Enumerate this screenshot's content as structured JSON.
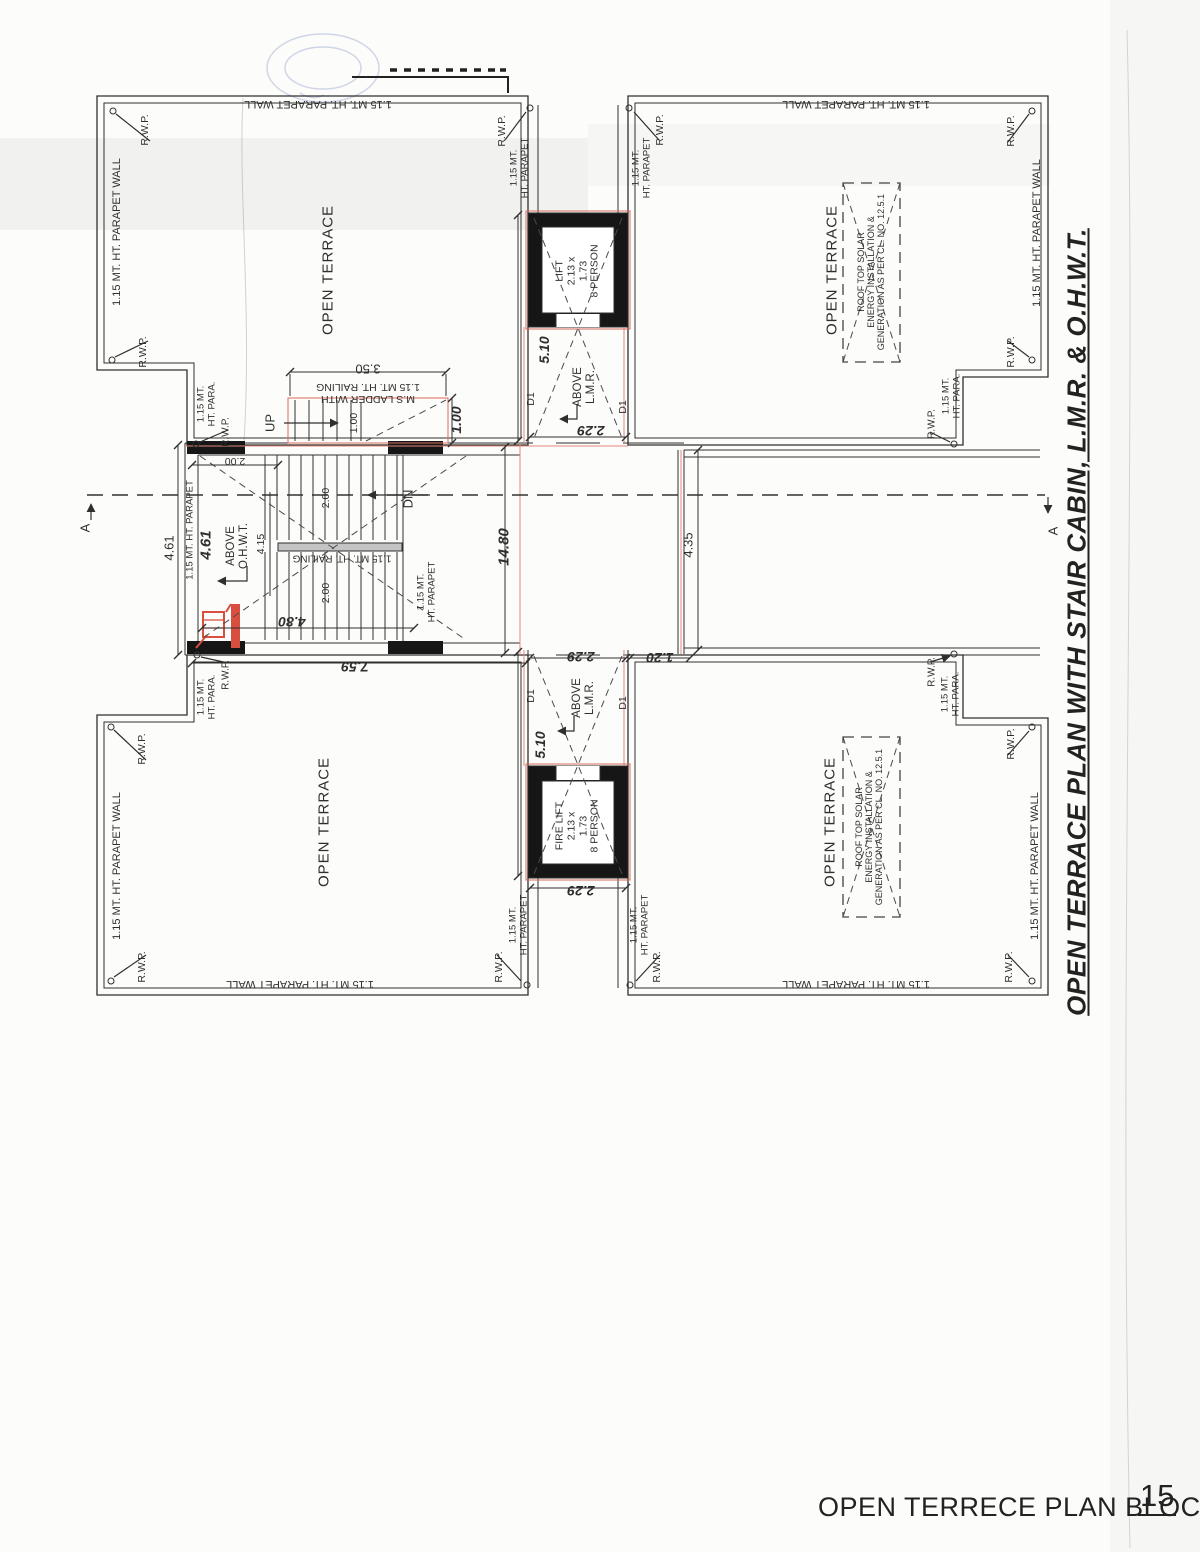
{
  "drawing": {
    "title": "OPEN TERRACE PLAN  WITH STAIR CABIN, L.M.R. & O.H.W.T.",
    "caption": "OPEN TERRECE PLAN BLOCK C",
    "page_number": "15"
  },
  "colors": {
    "line": "#2f2f2f",
    "wall_fill": "#161616",
    "red_overlay": "#d96a5c",
    "stamp_blue": "#7286bd",
    "paper": "#fcfcfa"
  },
  "labels": [
    {
      "n": "parapet-wall-label",
      "t": "1.15 MT. HT. PARAPET WALL",
      "x": 318,
      "y": 104,
      "r": 180,
      "s": 11
    },
    {
      "n": "parapet-wall-label",
      "t": "1.15 MT. HT. PARAPET WALL",
      "x": 117,
      "y": 232,
      "r": -90,
      "s": 11
    },
    {
      "n": "rwp-label",
      "t": "R.W.P.",
      "x": 146,
      "y": 130,
      "r": -90,
      "s": 10.5
    },
    {
      "n": "rwp-label",
      "t": "R.W.P.",
      "x": 503,
      "y": 131,
      "r": -90,
      "s": 10.5
    },
    {
      "n": "rwp-label",
      "t": "R.W.P.",
      "x": 144,
      "y": 352,
      "r": -90,
      "s": 10.5
    },
    {
      "n": "rwp-label",
      "t": "R.W.P.",
      "x": 226,
      "y": 432,
      "r": -90,
      "s": 10
    },
    {
      "n": "parapet-notch-label",
      "t": "1.15 MT.\nHT. PARA.",
      "x": 207,
      "y": 404,
      "r": -90,
      "s": 9.5
    },
    {
      "n": "parapet-label",
      "t": "1.15 MT.\nHT. PARAPET",
      "x": 520,
      "y": 168,
      "r": -90,
      "s": 9.5
    },
    {
      "n": "open-terrace-label",
      "t": "OPEN TERRACE",
      "x": 329,
      "y": 270,
      "r": -90,
      "s": 15,
      "ls": 1
    },
    {
      "n": "parapet-wall-label",
      "t": "1.15 MT. HT. PARAPET WALL",
      "x": 856,
      "y": 104,
      "r": 180,
      "s": 11
    },
    {
      "n": "parapet-wall-label",
      "t": "1.15 MT. HT. PARAPET WALL",
      "x": 1037,
      "y": 233,
      "r": -90,
      "s": 11
    },
    {
      "n": "rwp-label",
      "t": "R.W.P.",
      "x": 661,
      "y": 130,
      "r": -90,
      "s": 10.5
    },
    {
      "n": "rwp-label",
      "t": "R.W.P.",
      "x": 1012,
      "y": 131,
      "r": -90,
      "s": 10.5
    },
    {
      "n": "rwp-label",
      "t": "R.W.P.",
      "x": 1012,
      "y": 352,
      "r": -90,
      "s": 10.5
    },
    {
      "n": "rwp-label",
      "t": "R.W.P.",
      "x": 932,
      "y": 424,
      "r": -90,
      "s": 10
    },
    {
      "n": "parapet-notch-label",
      "t": "1.15 MT.\nHT. PARA.",
      "x": 952,
      "y": 396,
      "r": -90,
      "s": 9.5
    },
    {
      "n": "parapet-label",
      "t": "1.15 MT.\nHT. PARAPET",
      "x": 642,
      "y": 168,
      "r": -90,
      "s": 9.5
    },
    {
      "n": "open-terrace-label",
      "t": "OPEN TERRACE",
      "x": 833,
      "y": 270,
      "r": -90,
      "s": 15,
      "ls": 1
    },
    {
      "n": "solar-note",
      "t": "ROOF TOP SOLAR\nENERGY INSTALLATION &\nGENERATION AS PER CL. NO. 12.5.1",
      "x": 871,
      "y": 272,
      "r": -90,
      "s": 9
    },
    {
      "n": "dim-3-50",
      "t": "3.50",
      "x": 368,
      "y": 368,
      "r": 180,
      "s": 13
    },
    {
      "n": "ladder-note",
      "t": "M.S LADDER WITH\n1.15 MT. HT. RAILING",
      "x": 368,
      "y": 392,
      "r": 180,
      "s": 10.5
    },
    {
      "n": "up-label",
      "t": "UP",
      "x": 271,
      "y": 423,
      "r": -90,
      "s": 13
    },
    {
      "n": "dim-1-00",
      "t": "1.00",
      "x": 355,
      "y": 423,
      "r": -90,
      "s": 10.5
    },
    {
      "n": "dim-1-00",
      "t": "1.00",
      "x": 457,
      "y": 420,
      "r": -90,
      "s": 14,
      "w": 1,
      "i": 1
    },
    {
      "n": "door-d1-label",
      "t": "D1",
      "x": 532,
      "y": 399,
      "r": -90,
      "s": 10.5
    },
    {
      "n": "door-d1-label",
      "t": "D1",
      "x": 624,
      "y": 407,
      "r": -90,
      "s": 10.5
    },
    {
      "n": "dim-2-00",
      "t": "2.00",
      "x": 235,
      "y": 460,
      "r": 180,
      "s": 10.5
    },
    {
      "n": "dim-4-61",
      "t": "4.61",
      "x": 170,
      "y": 548,
      "r": -90,
      "s": 13
    },
    {
      "n": "dim-4-61",
      "t": "4.61",
      "x": 207,
      "y": 545,
      "r": -90,
      "s": 15,
      "w": 1,
      "i": 1
    },
    {
      "n": "parapet-label",
      "t": "1.15 MT. HT. PARAPET",
      "x": 191,
      "y": 530,
      "r": -90,
      "s": 9.5
    },
    {
      "n": "above-ohwt-note",
      "t": "ABOVE\nO.H.W.T.",
      "x": 238,
      "y": 546,
      "r": -90,
      "s": 11.5
    },
    {
      "n": "dim-2-00",
      "t": "2.00",
      "x": 327,
      "y": 498,
      "r": -90,
      "s": 10.5
    },
    {
      "n": "dim-4-15",
      "t": "4.15",
      "x": 262,
      "y": 544,
      "r": -90,
      "s": 10.5
    },
    {
      "n": "dim-2-00",
      "t": "2.00",
      "x": 327,
      "y": 593,
      "r": -90,
      "s": 10.5
    },
    {
      "n": "railing-note",
      "t": "1.15 MT. HT. RAILING",
      "x": 342,
      "y": 558,
      "r": 180,
      "s": 10
    },
    {
      "n": "dn-label",
      "t": "DN",
      "x": 409,
      "y": 499,
      "r": -90,
      "s": 13
    },
    {
      "n": "parapet-label",
      "t": "1.15 MT.\nHT. PARAPET",
      "x": 427,
      "y": 592,
      "r": -90,
      "s": 9.5
    },
    {
      "n": "dim-4-80",
      "t": "4.80",
      "x": 292,
      "y": 621,
      "r": 180,
      "s": 14,
      "w": 1,
      "i": 1
    },
    {
      "n": "dim-7-59",
      "t": "7.59",
      "x": 355,
      "y": 666,
      "r": 180,
      "s": 14,
      "w": 1,
      "i": 1
    },
    {
      "n": "dim-14-80",
      "t": "14.80",
      "x": 505,
      "y": 547,
      "r": -90,
      "s": 15,
      "w": 1,
      "i": 1
    },
    {
      "n": "dim-4-35",
      "t": "4.35",
      "x": 689,
      "y": 545,
      "r": -90,
      "s": 13
    },
    {
      "n": "section-marker-a",
      "t": "A",
      "x": 86,
      "y": 528,
      "r": -90,
      "s": 13
    },
    {
      "n": "section-marker-a",
      "t": "A",
      "x": 1054,
      "y": 531,
      "r": -90,
      "s": 13
    },
    {
      "n": "lift-label",
      "t": "LIFT\n2.13 x\n1.73\n8 PERSON",
      "x": 578,
      "y": 271,
      "r": -90,
      "s": 10.5
    },
    {
      "n": "dim-5-10",
      "t": "5.10",
      "x": 545,
      "y": 350,
      "r": -90,
      "s": 14,
      "w": 1,
      "i": 1
    },
    {
      "n": "above-lmr-note",
      "t": "ABOVE\nL.M.R.",
      "x": 585,
      "y": 387,
      "r": -90,
      "s": 11.5
    },
    {
      "n": "dim-2-29",
      "t": "2.29",
      "x": 591,
      "y": 430,
      "r": 180,
      "s": 14,
      "w": 1,
      "i": 1
    },
    {
      "n": "dim-2-29",
      "t": "2.29",
      "x": 581,
      "y": 656,
      "r": 180,
      "s": 14,
      "w": 1,
      "i": 1
    },
    {
      "n": "dim-1-20",
      "t": "1.20",
      "x": 660,
      "y": 657,
      "r": 180,
      "s": 14,
      "w": 1,
      "i": 1
    },
    {
      "n": "door-d1-label",
      "t": "D1",
      "x": 532,
      "y": 696,
      "r": -90,
      "s": 10.5
    },
    {
      "n": "door-d1-label",
      "t": "D1",
      "x": 624,
      "y": 703,
      "r": -90,
      "s": 10.5
    },
    {
      "n": "above-lmr-note",
      "t": "ABOVE\nL.M.R.",
      "x": 584,
      "y": 698,
      "r": -90,
      "s": 11.5
    },
    {
      "n": "dim-5-10",
      "t": "5.10",
      "x": 541,
      "y": 745,
      "r": -90,
      "s": 14,
      "w": 1,
      "i": 1
    },
    {
      "n": "fire-lift-label",
      "t": "FIRE LIFT\n2.13 x\n1.73\n8 PERSON",
      "x": 578,
      "y": 826,
      "r": -90,
      "s": 10.5
    },
    {
      "n": "dim-2-29",
      "t": "2.29",
      "x": 581,
      "y": 890,
      "r": 180,
      "s": 14,
      "w": 1,
      "i": 1
    },
    {
      "n": "rwp-label",
      "t": "R.W.P.",
      "x": 226,
      "y": 675,
      "r": -90,
      "s": 10
    },
    {
      "n": "parapet-notch-label",
      "t": "1.15 MT.\nHT. PARA.",
      "x": 207,
      "y": 697,
      "r": -90,
      "s": 9.5
    },
    {
      "n": "rwp-label",
      "t": "R.W.P.",
      "x": 143,
      "y": 749,
      "r": -90,
      "s": 10.5
    },
    {
      "n": "parapet-wall-label",
      "t": "1.15 MT. HT. PARAPET WALL",
      "x": 117,
      "y": 866,
      "r": -90,
      "s": 11
    },
    {
      "n": "rwp-label",
      "t": "R.W.P.",
      "x": 143,
      "y": 967,
      "r": -90,
      "s": 10.5
    },
    {
      "n": "parapet-wall-label",
      "t": "1.15 MT. HT. PARAPET WALL",
      "x": 300,
      "y": 984,
      "r": 180,
      "s": 11
    },
    {
      "n": "rwp-label",
      "t": "R.W.P.",
      "x": 500,
      "y": 967,
      "r": -90,
      "s": 10.5
    },
    {
      "n": "parapet-label",
      "t": "1.15 MT.\nHT. PARAPET",
      "x": 519,
      "y": 925,
      "r": -90,
      "s": 9.5
    },
    {
      "n": "open-terrace-label",
      "t": "OPEN TERRACE",
      "x": 325,
      "y": 822,
      "r": -90,
      "s": 15,
      "ls": 1
    },
    {
      "n": "rwp-label",
      "t": "R.W.P.",
      "x": 932,
      "y": 672,
      "r": -90,
      "s": 10
    },
    {
      "n": "parapet-notch-label",
      "t": "1.15 MT.\nHT. PARA.",
      "x": 951,
      "y": 694,
      "r": -90,
      "s": 9.5
    },
    {
      "n": "rwp-label",
      "t": "R.W.P.",
      "x": 1012,
      "y": 744,
      "r": -90,
      "s": 10.5
    },
    {
      "n": "parapet-wall-label",
      "t": "1.15 MT. HT. PARAPET WALL",
      "x": 1035,
      "y": 866,
      "r": -90,
      "s": 11
    },
    {
      "n": "parapet-label",
      "t": "1.15 MT.\nHT. PARAPET",
      "x": 640,
      "y": 925,
      "r": -90,
      "s": 9.5
    },
    {
      "n": "rwp-label",
      "t": "R.W.P.",
      "x": 658,
      "y": 967,
      "r": -90,
      "s": 10.5
    },
    {
      "n": "rwp-label",
      "t": "R.W.P.",
      "x": 1010,
      "y": 967,
      "r": -90,
      "s": 10.5
    },
    {
      "n": "parapet-wall-label",
      "t": "1.15 MT. HT. PARAPET WALL",
      "x": 856,
      "y": 984,
      "r": 180,
      "s": 11
    },
    {
      "n": "open-terrace-label",
      "t": "OPEN TERRACE",
      "x": 831,
      "y": 822,
      "r": -90,
      "s": 15,
      "ls": 1
    },
    {
      "n": "solar-note",
      "t": "ROOF TOP SOLAR\nENERGY INSTALLATION &\nGENERATION AS PER CL. NO. 12.5.1",
      "x": 869,
      "y": 827,
      "r": -90,
      "s": 9
    }
  ]
}
